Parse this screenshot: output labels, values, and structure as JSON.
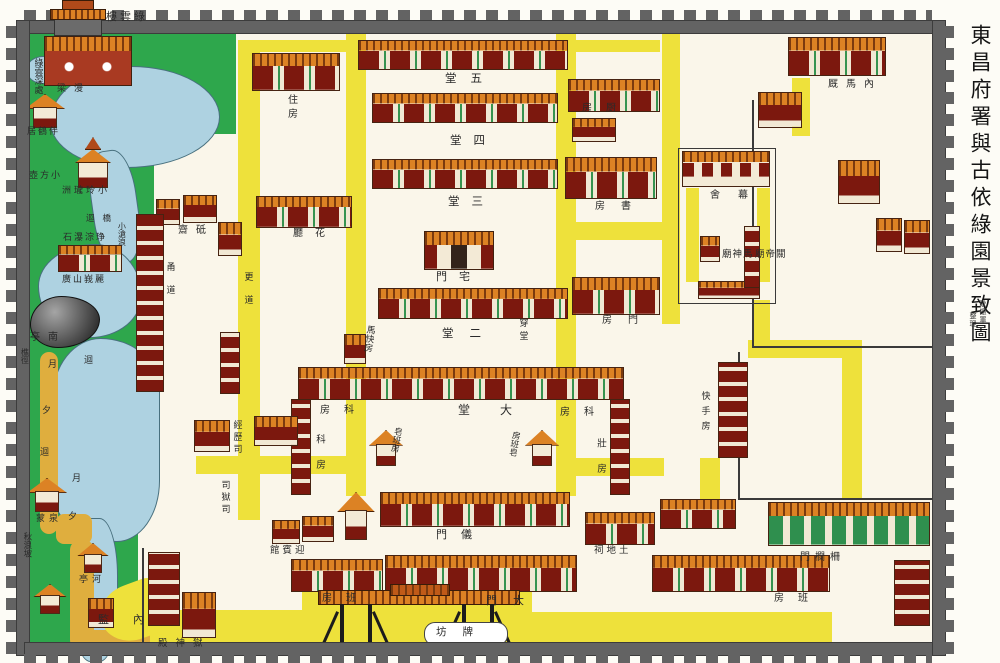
{
  "title_panel": {
    "title": "東昌府署與古依綠園景致圖",
    "credit_name": "耿振軍",
    "credit_role": "整理"
  },
  "colors": {
    "garden_green": "#2ea74c",
    "path_yellow": "#eee13b",
    "garden_path_ochre": "#dfae3e",
    "water_blue": "#aed2e1",
    "building_red": "#7c180e",
    "roof_orange": "#dc8224",
    "door_green": "#36934f",
    "wall_gray": "#636363",
    "ground_cream": "#faf6ea"
  },
  "map": {
    "labels": [
      {
        "n": "label-luyunlou",
        "t": "樓雲綠",
        "x": 106,
        "y": 12,
        "s": 11,
        "ls": 3
      },
      {
        "n": "label-luyun-shenchu",
        "t": "綠雲深處",
        "x": 33,
        "y": 58,
        "s": 9,
        "v": 1
      },
      {
        "n": "label-manliang",
        "t": "梁漫",
        "x": 57,
        "y": 84,
        "s": 9,
        "ls": 8
      },
      {
        "n": "label-banheju",
        "t": "居鶴伴",
        "x": 27,
        "y": 127,
        "s": 9,
        "ls": 2
      },
      {
        "n": "label-xiaofanghu",
        "t": "壺方小",
        "x": 29,
        "y": 171,
        "s": 9,
        "ls": 2
      },
      {
        "n": "label-xiaolinglongzhou",
        "t": "洲瓏玲小",
        "x": 62,
        "y": 186,
        "s": 9,
        "ls": 3
      },
      {
        "n": "label-huiqiao",
        "t": "迴橋",
        "x": 86,
        "y": 214,
        "s": 8.5,
        "ls": 8
      },
      {
        "n": "label-xiaocanglang",
        "t": "小滄浪",
        "x": 117,
        "y": 222,
        "s": 8,
        "v": 1
      },
      {
        "n": "label-shipu",
        "t": "石瀑淙琤",
        "x": 63,
        "y": 233,
        "s": 9,
        "ls": 2
      },
      {
        "n": "label-guangshan",
        "t": "廣山峩麗",
        "x": 62,
        "y": 275,
        "s": 9,
        "ls": 2
      },
      {
        "n": "label-nanting",
        "t": "亭南",
        "x": 30,
        "y": 333,
        "s": 10,
        "ls": 8
      },
      {
        "n": "label-qiaojing",
        "t": "樵徑",
        "x": 20,
        "y": 348,
        "s": 8,
        "v": 1
      },
      {
        "n": "label-path-hui-1",
        "t": "迴",
        "x": 84,
        "y": 356,
        "s": 9
      },
      {
        "n": "label-path-yue-1",
        "t": "月",
        "x": 48,
        "y": 360,
        "s": 9
      },
      {
        "n": "label-path-xi-1",
        "t": "夕",
        "x": 42,
        "y": 406,
        "s": 9
      },
      {
        "n": "label-path-hui-2",
        "t": "迴",
        "x": 40,
        "y": 448,
        "s": 9
      },
      {
        "n": "label-path-yue-2",
        "t": "月",
        "x": 72,
        "y": 474,
        "s": 9
      },
      {
        "n": "label-path-xi-2",
        "t": "夕",
        "x": 68,
        "y": 512,
        "s": 9
      },
      {
        "n": "label-mengquan",
        "t": "蒙泉",
        "x": 36,
        "y": 514,
        "s": 9,
        "ls": 4
      },
      {
        "n": "label-qiulangpo",
        "t": "秋浪坡",
        "x": 23,
        "y": 532,
        "s": 8.5,
        "v": 1
      },
      {
        "n": "label-heting",
        "t": "亭河",
        "x": 79,
        "y": 575,
        "s": 9,
        "ls": 4
      },
      {
        "n": "label-jiannei",
        "t": "監內",
        "x": 98,
        "y": 615,
        "s": 11,
        "ls": 24
      },
      {
        "n": "label-yushendian",
        "t": "殿神獄",
        "x": 158,
        "y": 640,
        "s": 9.5,
        "ls": 8
      },
      {
        "n": "label-wutang",
        "t": "堂五",
        "x": 445,
        "y": 73,
        "s": 11.5,
        "ls": 14
      },
      {
        "n": "label-sitang",
        "t": "堂四",
        "x": 450,
        "y": 135,
        "s": 11.5,
        "ls": 12
      },
      {
        "n": "label-santang",
        "t": "堂三",
        "x": 448,
        "y": 196,
        "s": 11.5,
        "ls": 12
      },
      {
        "n": "label-zhaimen",
        "t": "門宅",
        "x": 436,
        "y": 272,
        "s": 11,
        "ls": 12
      },
      {
        "n": "label-ertang",
        "t": "堂二",
        "x": 442,
        "y": 328,
        "s": 11.5,
        "ls": 16
      },
      {
        "n": "label-datang",
        "t": "堂大",
        "x": 458,
        "y": 404,
        "s": 12,
        "ls": 30
      },
      {
        "n": "label-zhufang",
        "t": "住房",
        "x": 285,
        "y": 94,
        "s": 10,
        "v": 1,
        "ls": 4
      },
      {
        "n": "label-chufang",
        "t": "房厨",
        "x": 582,
        "y": 104,
        "s": 10,
        "ls": 14
      },
      {
        "n": "label-shufang",
        "t": "房書",
        "x": 595,
        "y": 202,
        "s": 10,
        "ls": 16
      },
      {
        "n": "label-mushe",
        "t": "舍幕",
        "x": 710,
        "y": 191,
        "s": 10,
        "ls": 18
      },
      {
        "n": "label-huating",
        "t": "廳花",
        "x": 293,
        "y": 229,
        "s": 10,
        "ls": 12
      },
      {
        "n": "label-dizhai",
        "t": "齋砥",
        "x": 178,
        "y": 226,
        "s": 10,
        "ls": 8
      },
      {
        "n": "label-yongdao",
        "t": "甬道",
        "x": 165,
        "y": 262,
        "s": 9,
        "v": 1,
        "ls": 14
      },
      {
        "n": "label-gengdao",
        "t": "更道",
        "x": 243,
        "y": 272,
        "s": 9,
        "v": 1,
        "ls": 14
      },
      {
        "n": "label-chuantang",
        "t": "穿堂",
        "x": 518,
        "y": 318,
        "s": 9,
        "v": 1,
        "ls": 4
      },
      {
        "n": "label-makuaifang",
        "t": "馬快房",
        "x": 364,
        "y": 325,
        "s": 9,
        "v": 1,
        "r": 8
      },
      {
        "n": "label-menfang",
        "t": "房門",
        "x": 602,
        "y": 316,
        "s": 10,
        "ls": 16
      },
      {
        "n": "label-kefang-left",
        "t": "房科",
        "x": 320,
        "y": 406,
        "s": 10,
        "ls": 14
      },
      {
        "n": "label-kefang-right",
        "t": "房科",
        "x": 560,
        "y": 408,
        "s": 10,
        "ls": 14
      },
      {
        "n": "label-kefang-west",
        "t": "科房",
        "x": 313,
        "y": 434,
        "s": 9.5,
        "v": 1,
        "ls": 16
      },
      {
        "n": "label-zhuangfang-east",
        "t": "壯房",
        "x": 594,
        "y": 438,
        "s": 9.5,
        "v": 1,
        "ls": 16
      },
      {
        "n": "label-zaobanfang-left",
        "t": "皂班房",
        "x": 392,
        "y": 427,
        "s": 8.5,
        "v": 1,
        "r": 10
      },
      {
        "n": "label-zaobanfang-right",
        "t": "房班皂",
        "x": 510,
        "y": 431,
        "s": 8.5,
        "v": 1,
        "r": 10
      },
      {
        "n": "label-kuaishoufang",
        "t": "快手房",
        "x": 700,
        "y": 391,
        "s": 9,
        "v": 1,
        "ls": 6
      },
      {
        "n": "label-yimen",
        "t": "門儀",
        "x": 436,
        "y": 530,
        "s": 11,
        "ls": 14
      },
      {
        "n": "label-damen",
        "t": "門大",
        "x": 486,
        "y": 596,
        "s": 11,
        "ls": 16
      },
      {
        "n": "label-paifang",
        "t": "坊牌",
        "x": 436,
        "y": 627,
        "s": 10.5,
        "ls": 16
      },
      {
        "n": "label-banfang-left",
        "t": "房班",
        "x": 322,
        "y": 594,
        "s": 10,
        "ls": 14
      },
      {
        "n": "label-banfang-right",
        "t": "房班",
        "x": 774,
        "y": 594,
        "s": 10,
        "ls": 14
      },
      {
        "n": "label-yingbinguan",
        "t": "館賓迎",
        "x": 270,
        "y": 547,
        "s": 9.5,
        "ls": 3
      },
      {
        "n": "label-tudici",
        "t": "祠地土",
        "x": 594,
        "y": 547,
        "s": 9.5,
        "ls": 3
      },
      {
        "n": "label-neimajiu",
        "t": "厩馬內",
        "x": 828,
        "y": 80,
        "s": 10,
        "ls": 8
      },
      {
        "n": "label-mashenmiao",
        "t": "廟神馬",
        "x": 722,
        "y": 251,
        "s": 9.5,
        "ls": 1
      },
      {
        "n": "label-guandimiao",
        "t": "廟帝關",
        "x": 755,
        "y": 251,
        "s": 9.5,
        "ls": 1
      },
      {
        "n": "label-zhalanmen",
        "t": "門欄柵",
        "x": 800,
        "y": 553,
        "s": 10,
        "ls": 5
      },
      {
        "n": "label-jinglisi",
        "t": "經歷司",
        "x": 232,
        "y": 420,
        "s": 9,
        "v": 1,
        "ls": 3
      },
      {
        "n": "label-siyusi",
        "t": "司獄司",
        "x": 220,
        "y": 480,
        "s": 9,
        "v": 1,
        "ls": 3
      }
    ],
    "buildings": [
      {
        "n": "building-wutang",
        "k": "hall",
        "x": 358,
        "y": 40,
        "w": 210,
        "h": 30
      },
      {
        "n": "building-sitang",
        "k": "hall",
        "x": 372,
        "y": 93,
        "w": 186,
        "h": 30
      },
      {
        "n": "building-santang",
        "k": "hall",
        "x": 372,
        "y": 159,
        "w": 186,
        "h": 30
      },
      {
        "n": "building-ertang",
        "k": "hall",
        "x": 378,
        "y": 288,
        "w": 190,
        "h": 31
      },
      {
        "n": "building-datang",
        "k": "hall",
        "x": 298,
        "y": 367,
        "w": 326,
        "h": 33
      },
      {
        "n": "building-west-wing",
        "k": "strip",
        "x": 291,
        "y": 399,
        "w": 20,
        "h": 96
      },
      {
        "n": "building-east-wing",
        "k": "strip",
        "x": 610,
        "y": 399,
        "w": 20,
        "h": 96
      },
      {
        "n": "building-yimen",
        "k": "hall",
        "x": 380,
        "y": 492,
        "w": 190,
        "h": 35
      },
      {
        "n": "building-east-corridor-hall",
        "k": "hall",
        "x": 660,
        "y": 499,
        "w": 76,
        "h": 30
      },
      {
        "n": "building-tudici",
        "k": "hall",
        "x": 585,
        "y": 512,
        "w": 70,
        "h": 33
      },
      {
        "n": "building-damen",
        "k": "hall",
        "x": 385,
        "y": 555,
        "w": 192,
        "h": 37
      },
      {
        "n": "building-banfang-left",
        "k": "hall",
        "x": 291,
        "y": 559,
        "w": 92,
        "h": 33
      },
      {
        "n": "building-banfang-right",
        "k": "hall",
        "x": 652,
        "y": 555,
        "w": 178,
        "h": 37
      },
      {
        "n": "building-zhufang",
        "k": "hall",
        "x": 252,
        "y": 53,
        "w": 88,
        "h": 38
      },
      {
        "n": "building-chufang",
        "k": "hall",
        "x": 568,
        "y": 79,
        "w": 92,
        "h": 33
      },
      {
        "n": "building-chufang-annex",
        "k": "house",
        "x": 572,
        "y": 118,
        "w": 44,
        "h": 24
      },
      {
        "n": "building-shufang",
        "k": "hall",
        "x": 565,
        "y": 157,
        "w": 92,
        "h": 42
      },
      {
        "n": "building-menfang",
        "k": "hall",
        "x": 572,
        "y": 277,
        "w": 88,
        "h": 38
      },
      {
        "n": "building-huating",
        "k": "hall",
        "x": 256,
        "y": 196,
        "w": 96,
        "h": 32
      },
      {
        "n": "building-dizhai-1",
        "k": "house",
        "x": 156,
        "y": 199,
        "w": 24,
        "h": 26
      },
      {
        "n": "building-dizhai-2",
        "k": "house",
        "x": 183,
        "y": 195,
        "w": 34,
        "h": 28
      },
      {
        "n": "building-west-strip",
        "k": "strip",
        "x": 136,
        "y": 214,
        "w": 28,
        "h": 178
      },
      {
        "n": "building-mid-gate",
        "k": "house",
        "x": 218,
        "y": 222,
        "w": 24,
        "h": 34
      },
      {
        "n": "building-mid-strip",
        "k": "strip",
        "x": 220,
        "y": 332,
        "w": 20,
        "h": 62
      },
      {
        "n": "building-jinglisi",
        "k": "house",
        "x": 194,
        "y": 420,
        "w": 36,
        "h": 32
      },
      {
        "n": "building-west-court-house",
        "k": "house",
        "x": 254,
        "y": 416,
        "w": 44,
        "h": 30
      },
      {
        "n": "building-yingbin-1",
        "k": "house",
        "x": 272,
        "y": 520,
        "w": 28,
        "h": 24
      },
      {
        "n": "building-yingbin-2",
        "k": "house",
        "x": 302,
        "y": 516,
        "w": 32,
        "h": 26
      },
      {
        "n": "building-yingbin-tower",
        "k": "pav",
        "x": 340,
        "y": 492,
        "w": 32,
        "h": 48
      },
      {
        "n": "building-prison-strip",
        "k": "strip",
        "x": 148,
        "y": 552,
        "w": 32,
        "h": 74
      },
      {
        "n": "building-yushendian",
        "k": "house",
        "x": 182,
        "y": 592,
        "w": 34,
        "h": 46
      },
      {
        "n": "building-bottom-left-house",
        "k": "house",
        "x": 88,
        "y": 598,
        "w": 26,
        "h": 30
      },
      {
        "n": "building-hex-pavilion",
        "k": "pav",
        "x": 30,
        "y": 478,
        "w": 34,
        "h": 34
      },
      {
        "n": "building-south-pavilion",
        "k": "pav",
        "x": 36,
        "y": 584,
        "w": 28,
        "h": 30
      },
      {
        "n": "building-stream-pavilion",
        "k": "pav",
        "x": 80,
        "y": 543,
        "w": 26,
        "h": 30
      },
      {
        "n": "building-rockery",
        "k": "rock",
        "x": 30,
        "y": 296,
        "w": 70,
        "h": 52
      },
      {
        "n": "building-pagoda",
        "k": "pagoda",
        "x": 78,
        "y": 162,
        "w": 30,
        "h": 26
      },
      {
        "n": "building-banheju",
        "k": "pav",
        "x": 28,
        "y": 94,
        "w": 34,
        "h": 34
      },
      {
        "n": "building-luyun-hall",
        "k": "tower2",
        "x": 44,
        "y": 36,
        "w": 88,
        "h": 50
      },
      {
        "n": "building-guangshan-hall",
        "k": "hall",
        "x": 58,
        "y": 245,
        "w": 64,
        "h": 27
      },
      {
        "n": "building-mushe-north",
        "k": "winhall",
        "x": 682,
        "y": 151,
        "w": 88,
        "h": 36
      },
      {
        "n": "building-mushe-south",
        "k": "house",
        "x": 698,
        "y": 281,
        "w": 62,
        "h": 18
      },
      {
        "n": "building-mushe-door",
        "k": "house",
        "x": 700,
        "y": 236,
        "w": 20,
        "h": 26
      },
      {
        "n": "building-mushe-east-strip",
        "k": "strip",
        "x": 744,
        "y": 226,
        "w": 16,
        "h": 62
      },
      {
        "n": "building-neimajiu",
        "k": "hall",
        "x": 788,
        "y": 37,
        "w": 98,
        "h": 39
      },
      {
        "n": "building-ne-house",
        "k": "house",
        "x": 838,
        "y": 160,
        "w": 42,
        "h": 44
      },
      {
        "n": "building-ne-small",
        "k": "house",
        "x": 758,
        "y": 92,
        "w": 44,
        "h": 36
      },
      {
        "n": "building-mashenmiao",
        "k": "house",
        "x": 876,
        "y": 218,
        "w": 26,
        "h": 34
      },
      {
        "n": "building-guandimiao",
        "k": "house",
        "x": 904,
        "y": 220,
        "w": 26,
        "h": 34
      },
      {
        "n": "building-kuaishou-strip",
        "k": "strip",
        "x": 718,
        "y": 362,
        "w": 30,
        "h": 96
      },
      {
        "n": "building-zhalanmen",
        "k": "greenDoors",
        "x": 768,
        "y": 502,
        "w": 162,
        "h": 44
      },
      {
        "n": "building-se-strip",
        "k": "strip",
        "x": 894,
        "y": 560,
        "w": 36,
        "h": 66
      },
      {
        "n": "building-corridor-gate",
        "k": "house",
        "x": 344,
        "y": 334,
        "w": 22,
        "h": 30
      },
      {
        "n": "building-zhaimen",
        "k": "gate",
        "x": 424,
        "y": 231,
        "w": 70,
        "h": 39
      },
      {
        "n": "building-zaoban-left",
        "k": "pav",
        "x": 372,
        "y": 430,
        "w": 28,
        "h": 36
      },
      {
        "n": "building-zaoban-right",
        "k": "pav",
        "x": 528,
        "y": 430,
        "w": 28,
        "h": 36
      }
    ]
  }
}
